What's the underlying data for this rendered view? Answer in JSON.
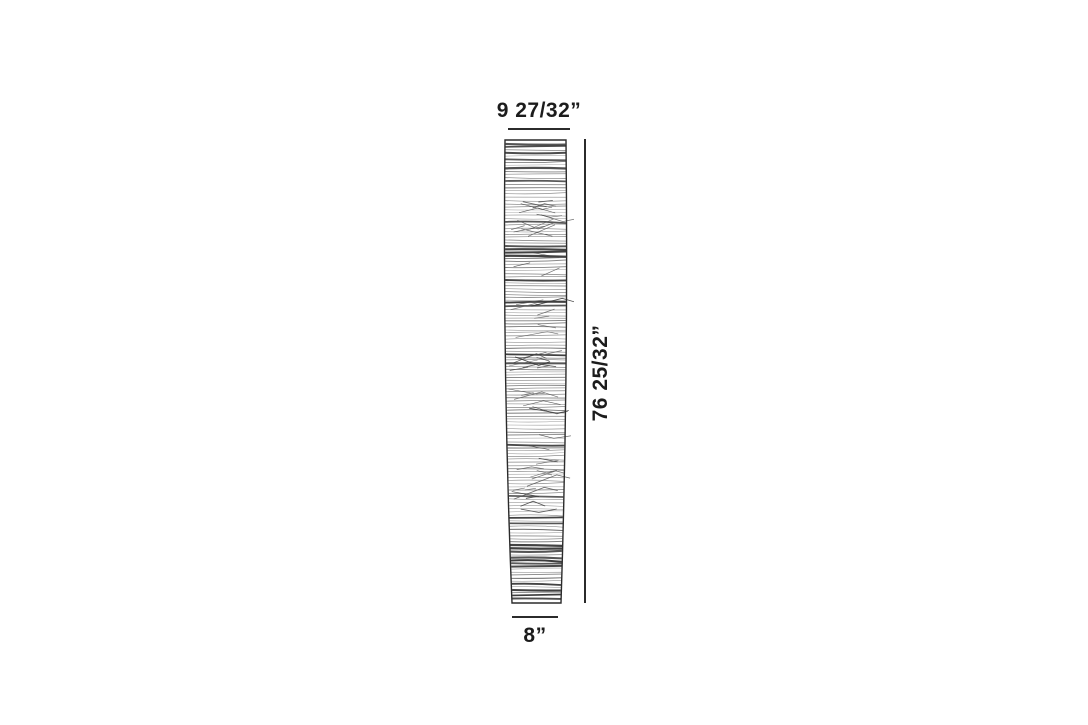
{
  "diagram": {
    "illustration": "tapered-floor-lamp-line-drawing",
    "labels": {
      "top_width": "9 27/32”",
      "height": "76 25/32”",
      "bottom_width": "8”"
    }
  }
}
